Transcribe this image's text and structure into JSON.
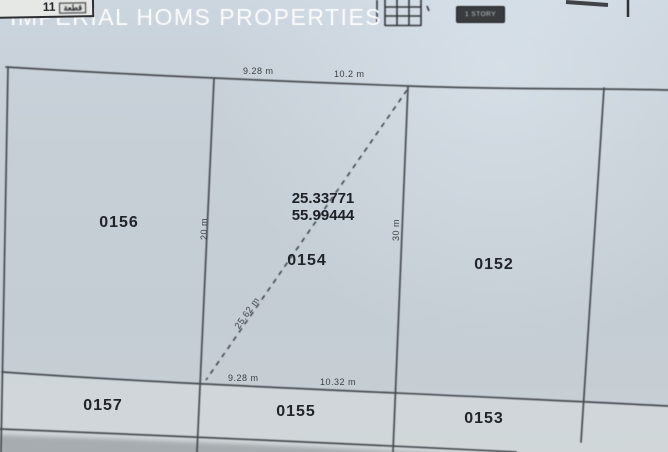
{
  "watermark": {
    "text": "IMPERIAL HOMS PROPERTIES"
  },
  "top_bar": {
    "corner_number": "11",
    "corner_label": "قطعة",
    "story_badge": "1 STORY"
  },
  "map": {
    "coordinates": {
      "latitude": "25.33771",
      "longitude": "55.99444"
    },
    "plots": [
      {
        "id": "0156"
      },
      {
        "id": "0154"
      },
      {
        "id": "0152"
      },
      {
        "id": "0157"
      },
      {
        "id": "0155"
      },
      {
        "id": "0153"
      }
    ],
    "dimensions": {
      "top_left": "9.28 m",
      "top_right": "10.2 m",
      "bottom_left": "9.28 m",
      "bottom_right": "10.32 m",
      "left_side": "20 m",
      "middle_side": "30 m",
      "diagonal": "25.62 m"
    }
  },
  "colors": {
    "background": "#c7d0d8",
    "line": "#474b51",
    "label_text": "#23262a",
    "watermark_text": "#ffffff",
    "badge_background": "#393c3f"
  }
}
